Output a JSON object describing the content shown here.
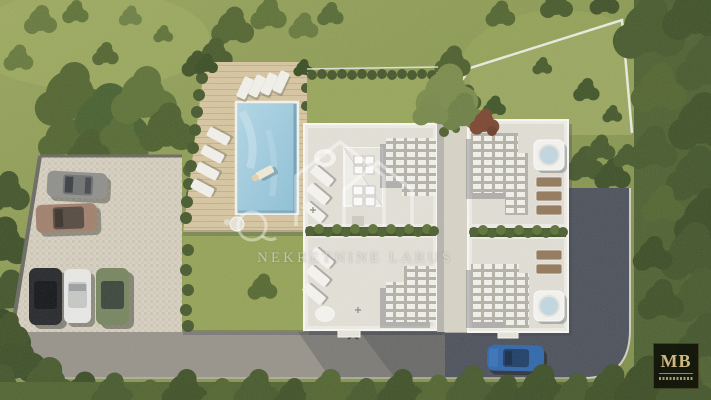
{
  "scene_label": "aerial-3d-architectural-render-twin-villas-with-pool-parking-and-access-road",
  "watermark": {
    "text": "NEKRETNINE LARUS"
  },
  "logo": {
    "monogram": "MB"
  },
  "scene": {
    "villas": 2,
    "units_per_villa": 2,
    "parking_cars": [
      "gray",
      "bronze",
      "black",
      "white",
      "green"
    ],
    "road_car_color": "blue",
    "features": [
      "rectangular pool with wood deck",
      "sun loungers",
      "rooftop pergolas",
      "hot tubs",
      "hedged gardens",
      "fenced grass plot",
      "asphalt access road",
      "paved parking lot"
    ]
  },
  "colors": {
    "grass": "#8a9a55",
    "trees": "#52652f",
    "deck": "#d8c6a0",
    "pool_water": "#9fcade",
    "building": "#efede6",
    "terrace": "#e4e1d8",
    "asphalt": "#4b505a",
    "concrete": "#97938a",
    "parking": "#d9d2c3",
    "logo_bg": "#15170d",
    "logo_gold": "#cdb87f"
  }
}
